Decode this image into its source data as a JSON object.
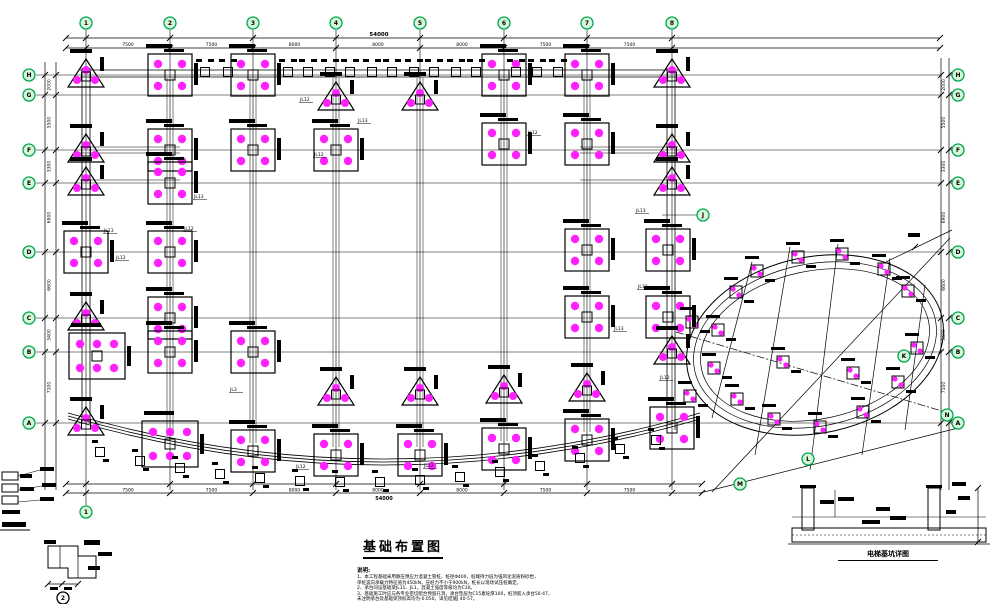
{
  "colors": {
    "green": "#00a651",
    "green_fill": "#d9f7d9",
    "magenta": "#ff22ff",
    "ink": "#000000",
    "bg": "#ffffff"
  },
  "title_block": {
    "title": "基础布置图",
    "notes_heading": "说明:",
    "notes": [
      "1、本工程基础采用静压预应力混凝土管桩，桩径Φ400，桩端持力层为强风化泥质粉砂岩，",
      "    单桩竖向承载力特征值为450kN，压桩力不小于900kN，桩长以现场试压桩确定。",
      "2、承台间设基础梁JL11、JL1，混凝土强度等级均为C30。",
      "3、基础施工时应与各专业密切配合预留孔洞，承台垫层为C15素砼厚100，桩顶嵌入承台50-47，",
      "    未注明承台及基础梁顶标高均为-0.050，详见结施J 40-57。"
    ]
  },
  "captions": {
    "section_detail": "电梯基坑详图",
    "detail_no": "2"
  },
  "axes": {
    "columns": [
      {
        "label": "1",
        "x": 86
      },
      {
        "label": "2",
        "x": 170
      },
      {
        "label": "3",
        "x": 253
      },
      {
        "label": "4",
        "x": 336
      },
      {
        "label": "5",
        "x": 420
      },
      {
        "label": "6",
        "x": 504
      },
      {
        "label": "7",
        "x": 587
      },
      {
        "label": "8",
        "x": 672
      }
    ],
    "rows": [
      {
        "label": "H",
        "y": 75
      },
      {
        "label": "G",
        "y": 95
      },
      {
        "label": "F",
        "y": 150
      },
      {
        "label": "E",
        "y": 183
      },
      {
        "label": "D",
        "y": 252
      },
      {
        "label": "C",
        "y": 318
      },
      {
        "label": "B",
        "y": 352
      },
      {
        "label": "A",
        "y": 423
      }
    ],
    "extra_bubbles": [
      {
        "label": "J",
        "x": 703,
        "y": 215
      },
      {
        "label": "K",
        "x": 904,
        "y": 356
      },
      {
        "label": "L",
        "x": 808,
        "y": 459
      },
      {
        "label": "M",
        "x": 740,
        "y": 484
      },
      {
        "label": "N",
        "x": 947,
        "y": 415
      },
      {
        "label": "1",
        "x": 86,
        "y": 512
      },
      {
        "label": "2",
        "x": 63,
        "y": 598,
        "ink": true
      }
    ]
  },
  "dimensions": {
    "top_overall": "54000",
    "top_segments": [
      "7500",
      "7500",
      "8000",
      "8000",
      "8000",
      "7500",
      "7500"
    ],
    "bottom_overall": "54000",
    "bottom_segments": [
      "7500",
      "7500",
      "8000",
      "8000",
      "8000",
      "7500",
      "7500"
    ],
    "left_segments": [
      "2000",
      "5500",
      "3300",
      "6900",
      "6600",
      "3400",
      "7100"
    ],
    "right_segments": [
      "2000",
      "5500",
      "3300",
      "6900",
      "6600",
      "3400",
      "7100"
    ]
  },
  "beam_labels": [
    {
      "t": "JL13",
      "x": 104,
      "y": 232
    },
    {
      "t": "JL12",
      "x": 116,
      "y": 259
    },
    {
      "t": "JL12",
      "x": 184,
      "y": 230
    },
    {
      "t": "JL13",
      "x": 194,
      "y": 198
    },
    {
      "t": "JL12",
      "x": 300,
      "y": 101
    },
    {
      "t": "JL12",
      "x": 314,
      "y": 156
    },
    {
      "t": "JL13",
      "x": 358,
      "y": 122
    },
    {
      "t": "JL12",
      "x": 528,
      "y": 134
    },
    {
      "t": "JL13",
      "x": 636,
      "y": 212
    },
    {
      "t": "JL12",
      "x": 638,
      "y": 288
    },
    {
      "t": "JL13",
      "x": 614,
      "y": 330
    },
    {
      "t": "JL12",
      "x": 660,
      "y": 379
    },
    {
      "t": "JL3",
      "x": 230,
      "y": 391
    },
    {
      "t": "JL12",
      "x": 296,
      "y": 468
    },
    {
      "t": "JL12",
      "x": 424,
      "y": 467
    }
  ],
  "caps": {
    "tri": [
      [
        86,
        75
      ],
      [
        672,
        75
      ],
      [
        336,
        98
      ],
      [
        420,
        98
      ],
      [
        86,
        150
      ],
      [
        672,
        150
      ],
      [
        86,
        183
      ],
      [
        672,
        183
      ],
      [
        86,
        318
      ],
      [
        672,
        352
      ],
      [
        86,
        423
      ],
      [
        336,
        393
      ],
      [
        420,
        393
      ],
      [
        504,
        391
      ],
      [
        587,
        389
      ]
    ],
    "sq4": [
      [
        170,
        75
      ],
      [
        253,
        75
      ],
      [
        504,
        75
      ],
      [
        587,
        75
      ],
      [
        170,
        150
      ],
      [
        253,
        150
      ],
      [
        336,
        150
      ],
      [
        504,
        144
      ],
      [
        587,
        144
      ],
      [
        170,
        183
      ],
      [
        86,
        252
      ],
      [
        170,
        252
      ],
      [
        587,
        250
      ],
      [
        668,
        250
      ],
      [
        170,
        318
      ],
      [
        587,
        317
      ],
      [
        668,
        317
      ],
      [
        170,
        352
      ],
      [
        253,
        352
      ],
      [
        253,
        451
      ],
      [
        336,
        455
      ],
      [
        420,
        455
      ],
      [
        504,
        449
      ],
      [
        587,
        440
      ],
      [
        672,
        428
      ]
    ],
    "sq6": [
      [
        97,
        356
      ],
      [
        170,
        444
      ]
    ],
    "wing": [
      [
        736,
        292
      ],
      [
        757,
        271
      ],
      [
        798,
        257
      ],
      [
        842,
        254
      ],
      [
        884,
        269
      ],
      [
        908,
        291
      ],
      [
        718,
        330
      ],
      [
        714,
        368
      ],
      [
        737,
        399
      ],
      [
        774,
        419
      ],
      [
        820,
        427
      ],
      [
        863,
        412
      ],
      [
        898,
        382
      ],
      [
        917,
        348
      ],
      [
        783,
        362
      ],
      [
        853,
        373
      ],
      [
        692,
        322
      ],
      [
        690,
        396
      ]
    ]
  },
  "footings": {
    "top_strip_y": 72,
    "top_strip_x": [
      205,
      228,
      288,
      308,
      330,
      350,
      372,
      392,
      414,
      434,
      456,
      476,
      516,
      537,
      558
    ],
    "arc": [
      [
        100,
        452
      ],
      [
        140,
        461
      ],
      [
        180,
        468
      ],
      [
        220,
        474
      ],
      [
        260,
        478
      ],
      [
        300,
        481
      ],
      [
        340,
        482
      ],
      [
        380,
        482
      ],
      [
        420,
        480
      ],
      [
        460,
        477
      ],
      [
        500,
        472
      ],
      [
        540,
        466
      ],
      [
        580,
        458
      ],
      [
        620,
        449
      ],
      [
        656,
        440
      ]
    ]
  }
}
